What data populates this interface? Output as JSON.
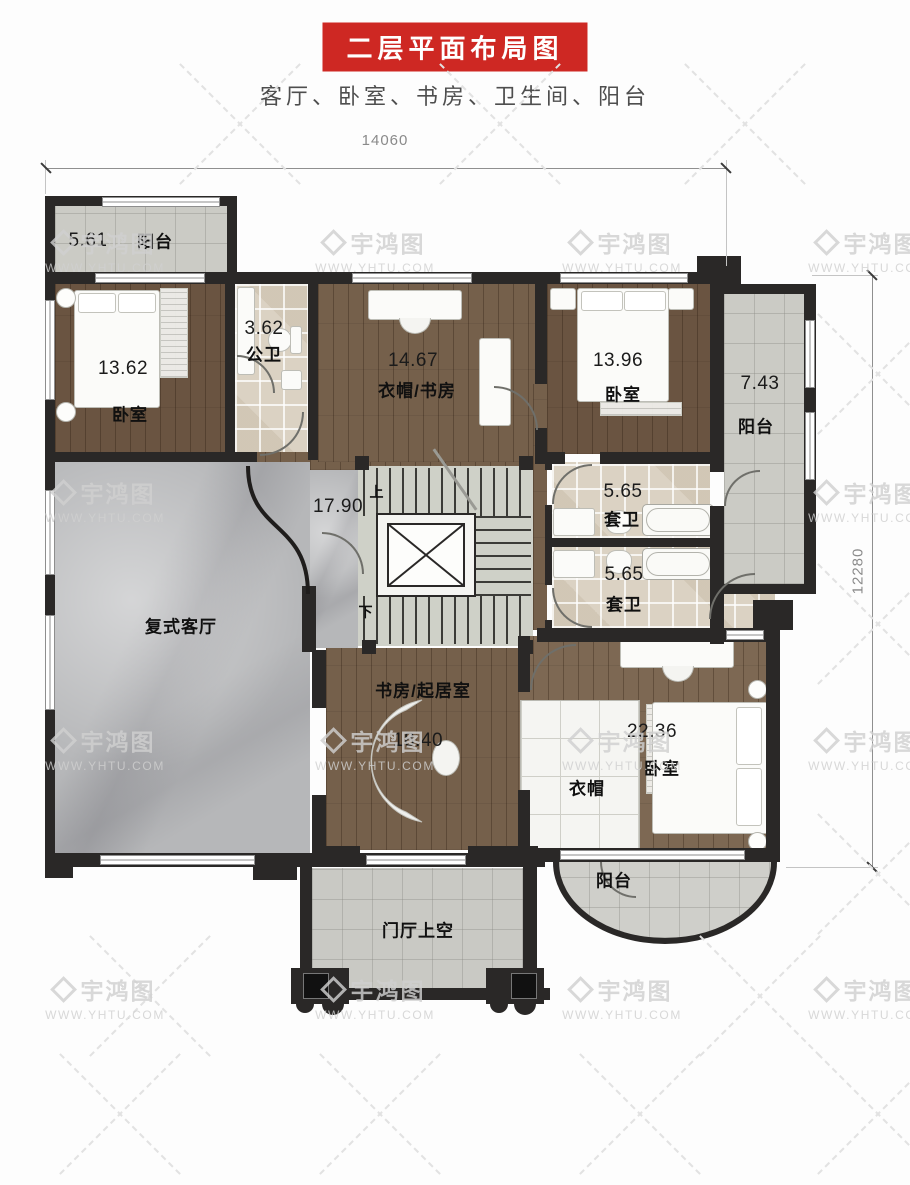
{
  "header": {
    "title": "二层平面布局图",
    "subtitle": "客厅、卧室、书房、卫生间、阳台"
  },
  "dimensions": {
    "top": "14060",
    "right": "12280"
  },
  "watermark": {
    "brand": "宇鸿图",
    "site": "WWW.YHTU.COM"
  },
  "stairs": {
    "up": "上",
    "down": "下"
  },
  "rooms": [
    {
      "id": "balcony-top-left",
      "name": "阳台",
      "area": "5.61"
    },
    {
      "id": "bedroom-top-left",
      "name": "卧室",
      "area": "13.62"
    },
    {
      "id": "bath-public",
      "name": "公卫",
      "area": "3.62"
    },
    {
      "id": "cloak-study",
      "name": "衣帽/书房",
      "area": "14.67"
    },
    {
      "id": "bedroom-top-right",
      "name": "卧室",
      "area": "13.96"
    },
    {
      "id": "balcony-right",
      "name": "阳台",
      "area": "7.43"
    },
    {
      "id": "stair-hall",
      "name": "",
      "area": "17.90"
    },
    {
      "id": "ensuite-1",
      "name": "套卫",
      "area": "5.65"
    },
    {
      "id": "ensuite-2",
      "name": "套卫",
      "area": "5.65"
    },
    {
      "id": "living-duplex",
      "name": "复式客厅",
      "area": ""
    },
    {
      "id": "study-living",
      "name": "书房/起居室",
      "area": "18.40"
    },
    {
      "id": "cloak",
      "name": "衣帽",
      "area": ""
    },
    {
      "id": "bedroom-bottom",
      "name": "卧室",
      "area": "22.36"
    },
    {
      "id": "balcony-bottom",
      "name": "阳台",
      "area": ""
    },
    {
      "id": "porch-void",
      "name": "门厅上空",
      "area": ""
    }
  ],
  "colors": {
    "accent_red": "#ce2823",
    "wall": "#2a2827",
    "wood": "#75604b",
    "marble": "#b6b7b9",
    "tile_beige": "#dbd2c3",
    "tile_gray": "#cbcbc5"
  }
}
